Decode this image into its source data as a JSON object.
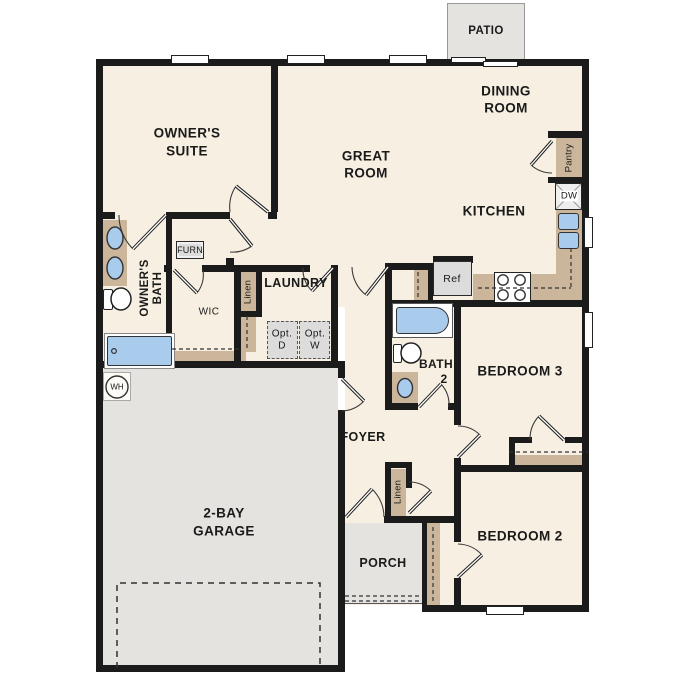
{
  "title": "floor-plan",
  "colors": {
    "floor": "#f7efe1",
    "hard_surface": "#e4e3e0",
    "wall": "#1b1b1b",
    "cabinet_tan": "#cbb69b",
    "fixture_blue": "#a9cbec",
    "appliance_gray": "#dcdcdc",
    "text": "#1a1a1a"
  },
  "rooms": {
    "patio": "PATIO",
    "dining_line1": "DINING",
    "dining_line2": "ROOM",
    "owners_suite_line1": "OWNER'S",
    "owners_suite_line2": "SUITE",
    "great_room_line1": "GREAT",
    "great_room_line2": "ROOM",
    "kitchen": "KITCHEN",
    "owners_bath_line1": "OWNER'S",
    "owners_bath_line2": "BATH",
    "wic": "WIC",
    "laundry": "LAUNDRY",
    "bath2_line1": "BATH",
    "bath2_line2": "2",
    "bedroom3": "BEDROOM 3",
    "bedroom2": "BEDROOM 2",
    "foyer": "FOYER",
    "porch": "PORCH",
    "garage_line1": "2-BAY",
    "garage_line2": "GARAGE"
  },
  "fixtures": {
    "furnace": "FURN",
    "pantry": "Pantry",
    "dishwasher": "DW",
    "refrigerator": "Ref",
    "linen_hall": "Linen",
    "linen_foyer": "Linen",
    "water_heater": "WH",
    "opt_dryer_line1": "Opt.",
    "opt_dryer_line2": "D",
    "opt_washer_line1": "Opt.",
    "opt_washer_line2": "W"
  }
}
